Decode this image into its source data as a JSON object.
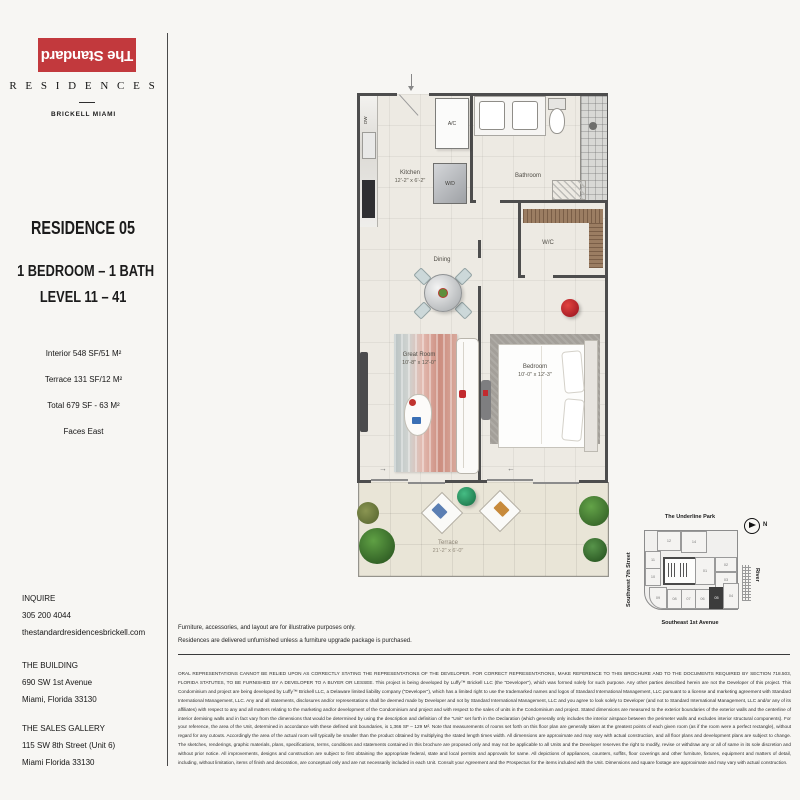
{
  "brand": {
    "logo_text": "The Standard",
    "residences_label": "R E S I D E N C E S",
    "location_label": "BRICKELL MIAMI",
    "accent_color": "#c2393d"
  },
  "residence": {
    "title": "RESIDENCE 05",
    "bed_bath": "1 BEDROOM – 1 BATH",
    "level": "LEVEL 11 – 41",
    "stats": [
      "Interior 548 SF/51 M²",
      "Terrace 131 SF/12 M²",
      "Total 679 SF - 63 M²",
      "Faces East"
    ]
  },
  "contact": {
    "inquire_label": "INQUIRE",
    "phone": "305 200 4044",
    "website": "thestandardresidencesbrickell.com",
    "building_label": "THE BUILDING",
    "building_addr1": "690 SW 1st Avenue",
    "building_addr2": "Miami, Florida 33130",
    "gallery_label": "THE SALES GALLERY",
    "gallery_addr1": "115 SW 8th Street (Unit 6)",
    "gallery_addr2": "Miami Florida 33130"
  },
  "floorplan": {
    "kitchen_name": "Kitchen",
    "kitchen_dims": "12'-2\" x 6'-2\"",
    "bathroom_name": "Bathroom",
    "ac_label": "A/C",
    "wd_label": "W/D",
    "dw_label": "DW",
    "wc_label": "W/C",
    "dining_label": "Dining",
    "great_room_name": "Great Room",
    "great_room_dims": "10'-8\" x 12'-0\"",
    "bedroom_name": "Bedroom",
    "bedroom_dims": "10'-0\" x 12'-3\"",
    "terrace_name": "Terrace",
    "terrace_dims": "21'-2\" x 6'-0\"",
    "arrow_right": "→",
    "arrow_left": "←"
  },
  "keyplan": {
    "park_label": "The Underline Park",
    "street_label": "Southwest 7th Street",
    "avenue_label": "Southeast 1st Avenue",
    "river_label": "River",
    "north_label": "N",
    "highlighted_unit": "05",
    "highlight_color": "#3c3c3c",
    "units": [
      "12",
      "14",
      "11",
      "10",
      "01",
      "02",
      "03",
      "09",
      "08",
      "07",
      "06",
      "05",
      "04"
    ]
  },
  "notes": {
    "line1": "Furniture, accessories, and layout are for illustrative purposes only.",
    "line2": "Residences are delivered unfurnished unless a furniture upgrade package is purchased."
  },
  "disclaimer": {
    "text": "ORAL REPRESENTATIONS CANNOT BE RELIED UPON AS CORRECTLY STATING THE REPRESENTATIONS OF THE DEVELOPER. FOR CORRECT REPRESENTATIONS, MAKE REFERENCE TO THIS BROCHURE AND TO THE DOCUMENTS REQUIRED BY SECTION 718.503, FLORIDA STATUTES, TO BE FURNISHED BY A DEVELOPER TO A BUYER OR LESSEE. This project is being developed by Luffy™ Brickell LLC (the \"Developer\"), which was formed solely for such purpose. Any other parties described herein are not the Developer of this project. This Condominium and project are being developed by Luffy™ Brickell LLC, a Delaware limited liability company (\"Developer\"), which has a limited right to use the trademarked names and logos of Standard International Management, LLC pursuant to a license and marketing agreement with Standard International Management, LLC. Any and all statements, disclosures and/or representations shall be deemed made by Developer and not by Standard International Management, LLC and you agree to look solely to Developer (and not to Standard International Management, LLC and/or any of its affiliates) with respect to any and all matters relating to the marketing and/or development of the Condominium and project and with respect to the sales of units in the Condominium and project. Stated dimensions are measured to the exterior boundaries of the exterior walls and the centerline of interior demising walls and in fact vary from the dimensions that would be determined by using the description and definition of the \"Unit\" set forth in the Declaration (which generally only includes the interior airspace between the perimeter walls and excludes interior structural components). For your reference, the area of the Unit, determined in accordance with these defined unit boundaries, is 1,366 SF – 129 M². Note that measurements of rooms set forth on this floor plan are generally taken at the greatest points of each given room (as if the room were a perfect rectangle), without regard for any cutouts. Accordingly the area of the actual room will typically be smaller than the product obtained by multiplying the stated length times width. All dimensions are approximate and may vary with actual construction, and all floor plans and development plans are subject to change. The sketches, renderings, graphic materials, plans, specifications, terms, conditions and statements contained in this brochure are proposed only and may not be applicable to all Units and the Developer reserves the right to modify, revise or withdraw any or all of same in its sole discretion and without prior notice. All improvements, designs and construction are subject to first obtaining the appropriate federal, state and local permits and approvals for same. All depictions of appliances, counters, soffits, floor coverings and other furniture, fixtures, equipment and matters of detail, including, without limitation, items of finish and decoration, are conceptual only and are not necessarily included in each Unit. Consult your Agreement and the Prospectus for the items included with the Unit. Dimensions and square footage are approximate and may vary with actual construction."
  }
}
